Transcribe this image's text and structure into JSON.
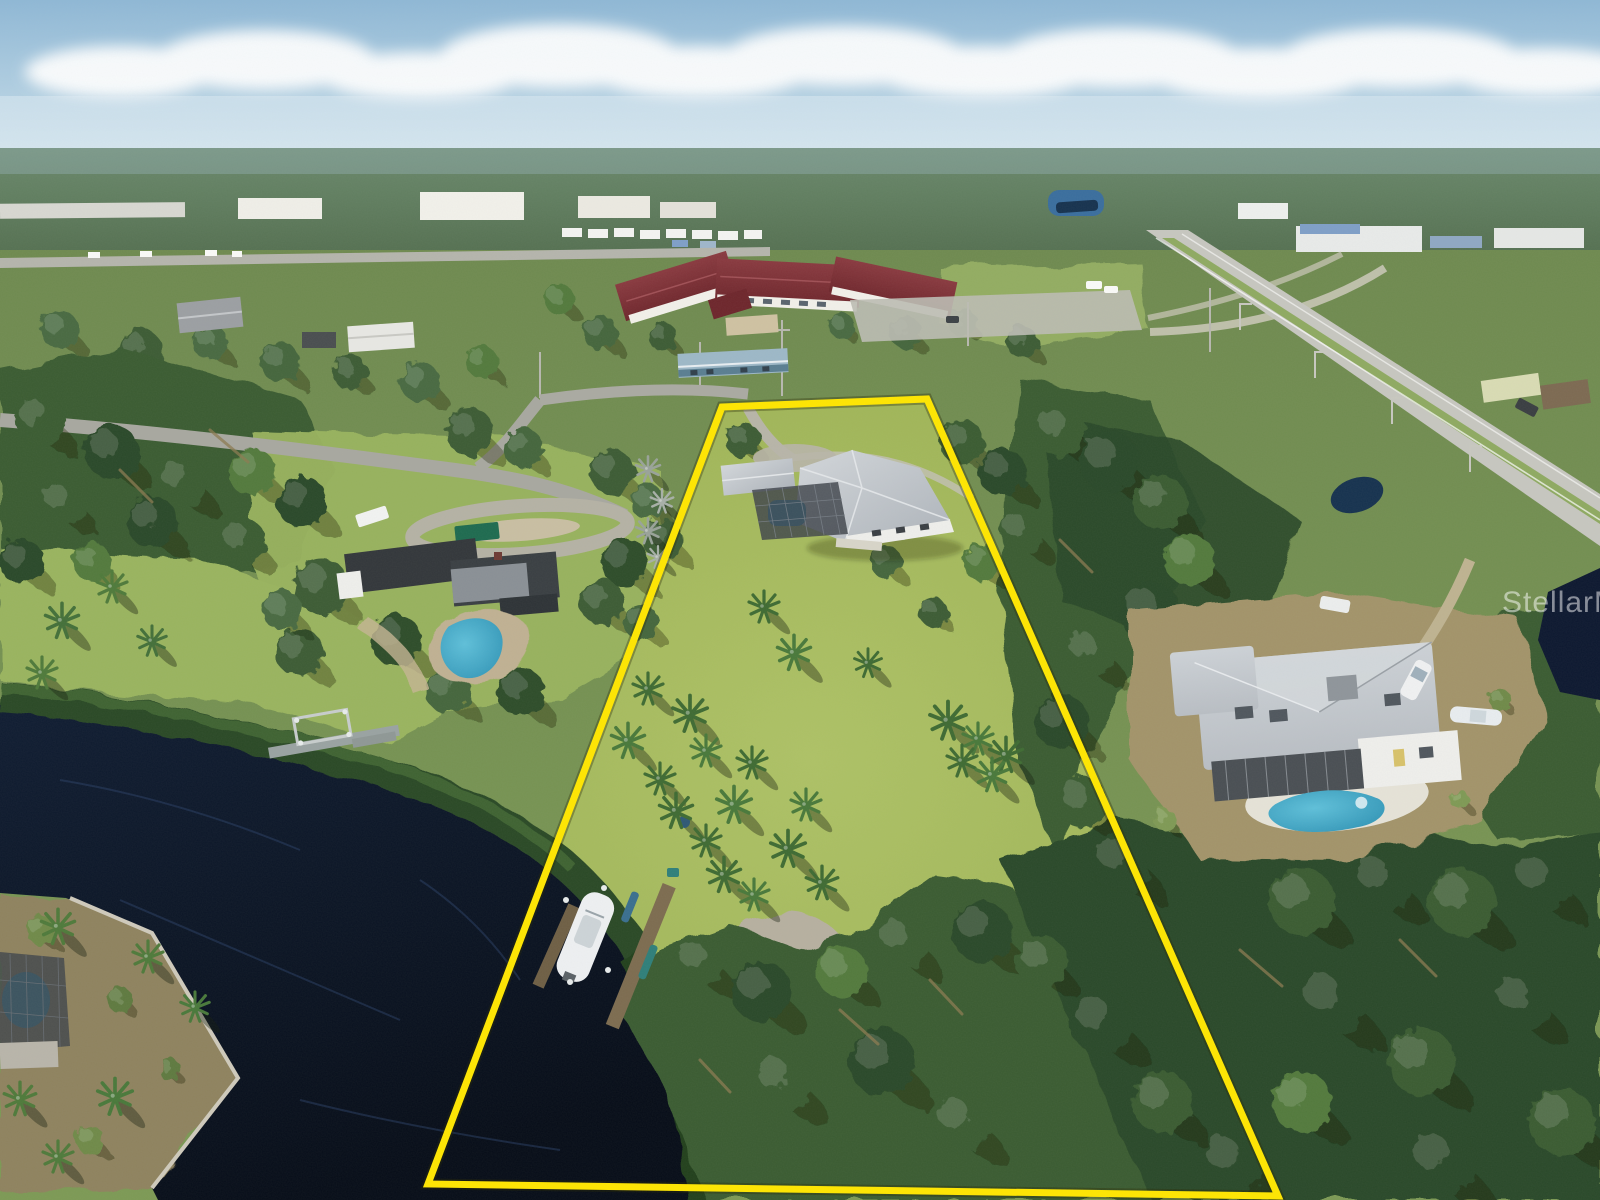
{
  "image": {
    "alt": "Aerial drone photo of a large grassy waterfront lot outlined in yellow, with a gray-roof house and screened pool, palm clusters, a dark canal with boat dock at lower left, neighboring homes with pools, a civic building with maroon roof and a highway in the background",
    "width": 1600,
    "height": 1200
  },
  "watermark": {
    "text": "StellarMLS",
    "color": "#ffffff",
    "opacity": 0.5
  },
  "property_outline": {
    "color": "#ffe600",
    "stroke_width": 7,
    "points": "722,407 927,399 1278,1196 428,1184"
  },
  "colors": {
    "sky_top": "#8fb8d6",
    "sky_bottom": "#cfe3ed",
    "cloud": "#ffffff",
    "haze": "#e4f0f6",
    "far_treeline": "#6b8a6d",
    "far_treeline_dark": "#546f50",
    "land_base": "#7d9a55",
    "land_deep": "#6f8a50",
    "grass_light": "#9ab45f",
    "field_green": "#93ad62",
    "lawn_main": "#aec266",
    "lawn_deep": "#97ad4f",
    "forest_dark": "#2c4929",
    "forest_mid": "#3b5c33",
    "forest_light": "#537a3e",
    "canopy_highlight": "#6d9348",
    "mangrove": "#2e4f2a",
    "water_deep": "#070d18",
    "water_mid": "#101d33",
    "water_glint": "#2a4066",
    "road_gray": "#b5b5ad",
    "highway_gray": "#c7c7c0",
    "path_light": "#cdc9bb",
    "driveway_gray": "#b8b5a8",
    "sand": "#c0b193",
    "dirt_clearing": "#a3946b",
    "scrub_brown": "#8f835f",
    "house_roof_light": "#d3d7db",
    "house_roof_dark": "#aeb4bb",
    "house_wall": "#efefec",
    "pool_cage_dark": "#3e434a",
    "cage_grid": "#7c838c",
    "pool_blue": "#2f93b5",
    "pool_aqua": "#5fc0da",
    "neighbor_roof_dark": "#33373b",
    "neighbor_metal": "#8a9096",
    "civic_roof": "#7b3038",
    "civic_roof_dark": "#6e262c",
    "civic_wall": "#f2f0ea",
    "civic_tan": "#cfc2a2",
    "right_roof": "#b9bec4",
    "lanai_dark": "#4a4f54",
    "dock_wood": "#7d6c50",
    "dock_wood_dark": "#6f5f45",
    "dock_gray": "#9aa3a2",
    "boat_white": "#eef0f2",
    "dumpster_green": "#1e6b50",
    "rv_white": "#f2f3f2",
    "kayak_blue": "#3a6f8f",
    "kayak_teal": "#2f7f7a",
    "umbrella_blue": "#3f7fb5",
    "pond_blue": "#3a6e9e",
    "pond_dark": "#16324f",
    "blue_roof_house": "#9db8c8"
  }
}
